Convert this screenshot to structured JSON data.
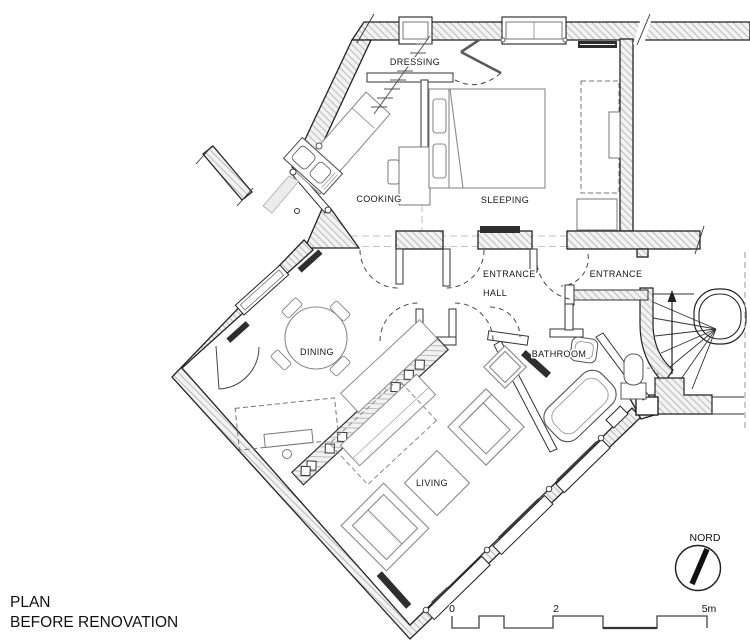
{
  "title": {
    "line1": "PLAN",
    "line2": "BEFORE RENOVATION"
  },
  "rooms": {
    "dressing": "DRESSING",
    "cooking": "COOKING",
    "sleeping": "SLEEPING",
    "entrance_hall_line1": "ENTRANCE",
    "entrance_hall_line2": "HALL",
    "entrance": "ENTRANCE",
    "dining": "DINING",
    "bathroom": "BATHROOM",
    "living": "LIVING"
  },
  "compass": {
    "label": "NORD"
  },
  "scale_bar": {
    "tick0": "0",
    "tick2": "2",
    "tick5": "5m"
  },
  "colors": {
    "wall_outline": "#222222",
    "hatch_line": "#b5b5b5",
    "furniture": "#777777",
    "dark_fixture": "#2e2e2e",
    "door_arc": "#444444"
  }
}
